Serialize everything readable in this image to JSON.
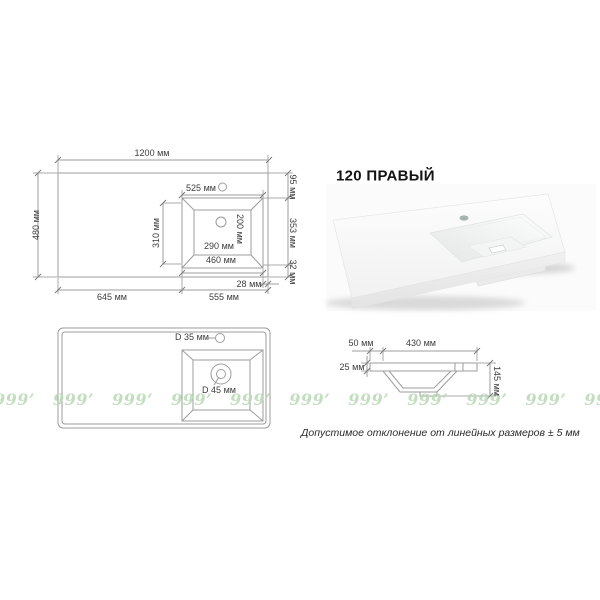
{
  "title": "120 ПРАВЫЙ",
  "note": "Допустимое отклонение от линейных размеров ± 5 мм",
  "watermark": "999’ 999’ 999’ 999’ 999’ 999’ 999’ 999’ 999’ 999’ 999’ 999’ 999’ 999’",
  "drawings": {
    "top_view": {
      "description": "top view of countertop with right-side sink, all linear dimensions",
      "labels": {
        "w1200": "1200 мм",
        "d480": "480 мм",
        "w525": "525 мм",
        "h95": "95 мм",
        "h353": "353 мм",
        "h32": "32 мм",
        "h310": "310 мм",
        "h200": "200 мм",
        "w290": "290 мм",
        "w460": "460 мм",
        "w28": "28 мм",
        "w645": "645 мм",
        "w555": "555 мм"
      }
    },
    "holes_view": {
      "description": "top view showing faucet and drain hole diameters",
      "labels": {
        "d35": "D 35 мм",
        "d45": "D 45 мм"
      }
    },
    "side_view": {
      "description": "cross-section of basin",
      "labels": {
        "w50": "50 мм",
        "w430": "430 мм",
        "t25": "25 мм",
        "h145": "145 мм"
      }
    }
  },
  "colors": {
    "line": "#9c9c9c",
    "text": "#3d3d3d",
    "watermark_green": "#b9d8b5"
  }
}
